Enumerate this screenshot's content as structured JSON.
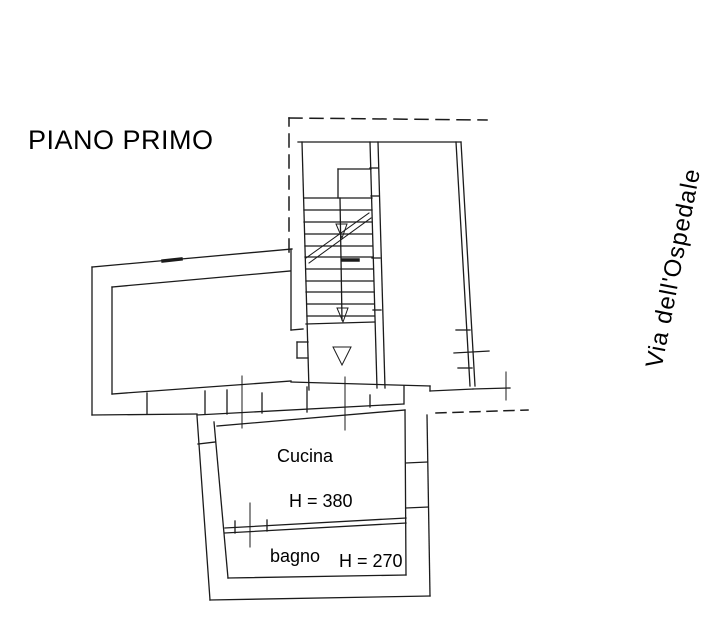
{
  "plan": {
    "title": "PIANO PRIMO",
    "street": "Via dell'Ospedale",
    "rooms": [
      {
        "name": "Cucina",
        "height_label": "H = 380"
      },
      {
        "name": "bagno",
        "height_label": "H = 270"
      }
    ]
  },
  "colors": {
    "background": "#ffffff",
    "line": "#1b1b1b",
    "text": "#000000"
  }
}
